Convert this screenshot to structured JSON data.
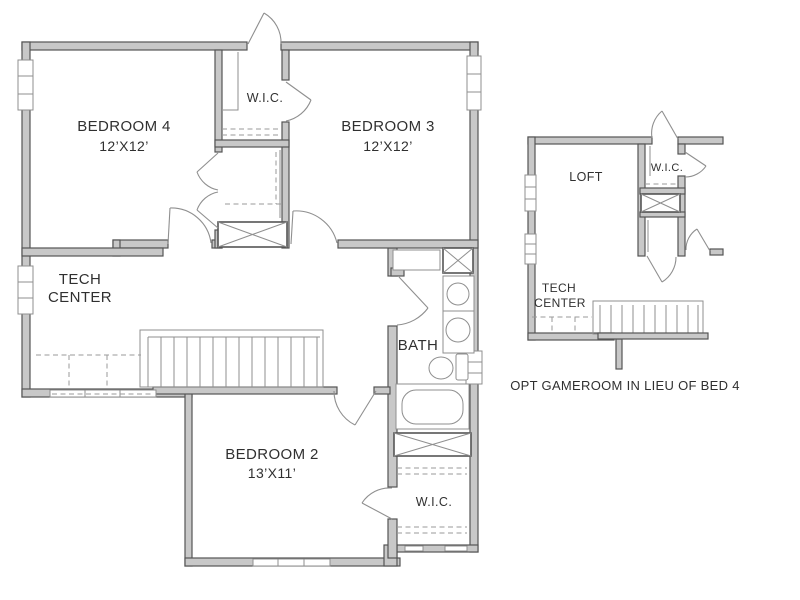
{
  "title": "Second floor plan with optional gameroom",
  "colors": {
    "background": "#ffffff",
    "wall_fill": "#c8c8c8",
    "wall_stroke": "#555555",
    "fixture_line": "#8f8f8f",
    "dash_color": "#9a9a9a",
    "text_color": "#303030"
  },
  "plan": {
    "rooms": {
      "bedroom4": {
        "label": "BEDROOM 4",
        "dims": "12’X12’"
      },
      "bedroom3": {
        "label": "BEDROOM 3",
        "dims": "12’X12’"
      },
      "bedroom2": {
        "label": "BEDROOM 2",
        "dims": "13’X11’"
      },
      "wic_top": {
        "label": "W.I.C."
      },
      "wic_bottom": {
        "label": "W.I.C."
      },
      "bath": {
        "label": "BATH"
      },
      "tech_center": {
        "line1": "TECH",
        "line2": "CENTER"
      }
    },
    "fixtures": [
      "double-vanity",
      "toilet",
      "bathtub",
      "staircase",
      "linen-closets",
      "tech-desk"
    ]
  },
  "inset": {
    "rooms": {
      "loft": {
        "label": "LOFT"
      },
      "wic": {
        "label": "W.I.C."
      },
      "tech_center": {
        "line1": "TECH",
        "line2": "CENTER"
      }
    },
    "caption": "OPT GAMEROOM IN LIEU OF BED 4"
  }
}
